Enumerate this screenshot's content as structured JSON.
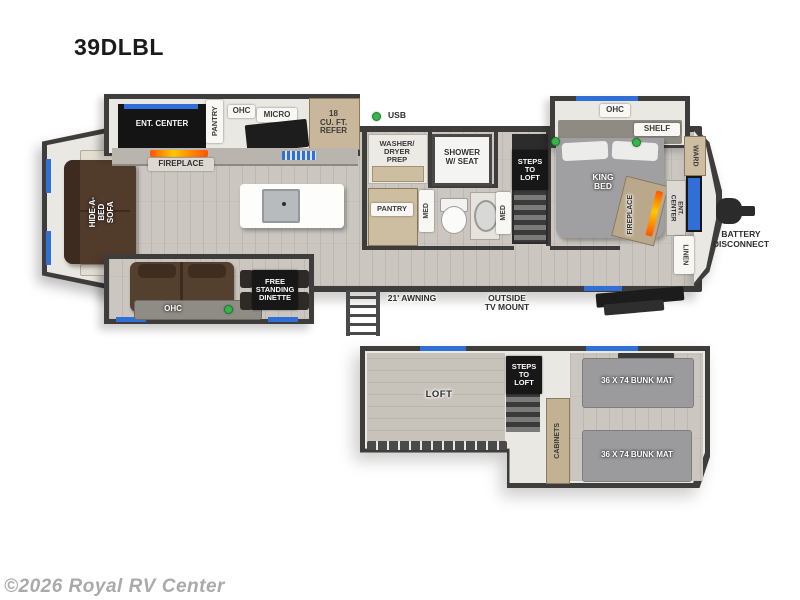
{
  "title": "39DLBL",
  "watermark": "©2026 Royal RV Center",
  "colors": {
    "wall": "#3e3d3b",
    "accent_blue": "#2f6fd6",
    "led_green": "#35b54a",
    "flame_orange": "#ff8a00",
    "floor": "#cbc7c0"
  },
  "main_floor": {
    "living": {
      "ent_center": "ENT. CENTER",
      "fireplace": "FIREPLACE",
      "hide_a_bed_sofa": "HIDE-A-BED\nSOFA",
      "ohc_sofa": "OHC",
      "dinette": "FREE\nSTANDING\nDINETTE"
    },
    "kitchen": {
      "pantry": "PANTRY",
      "ohc": "OHC",
      "micro": "MICRO",
      "refer": "18\nCU. FT.\nREFER",
      "usb": "USB"
    },
    "bath": {
      "washer_dryer": "WASHER/\nDRYER\nPREP",
      "shower": "SHOWER\nW/ SEAT",
      "pantry": "PANTRY",
      "med_left": "MED",
      "med_right": "MED"
    },
    "steps": "STEPS\nTO\nLOFT",
    "bedroom": {
      "king_bed": "KING\nBED",
      "ohc": "OHC",
      "shelf": "SHELF",
      "ward": "WARD",
      "fireplace": "FIREPLACE",
      "ent_center": "ENT. CENTER",
      "linen": "LINEN"
    },
    "exterior": {
      "awning": "21' AWNING",
      "tv_mount": "OUTSIDE\nTV MOUNT",
      "battery": "BATTERY\nDISCONNECT"
    }
  },
  "loft_floor": {
    "loft": "LOFT",
    "steps": "STEPS\nTO\nLOFT",
    "cabinets": "CABINETS",
    "bunk_top": "36 X 74 BUNK MAT",
    "bunk_bottom": "36 X 74 BUNK MAT"
  }
}
